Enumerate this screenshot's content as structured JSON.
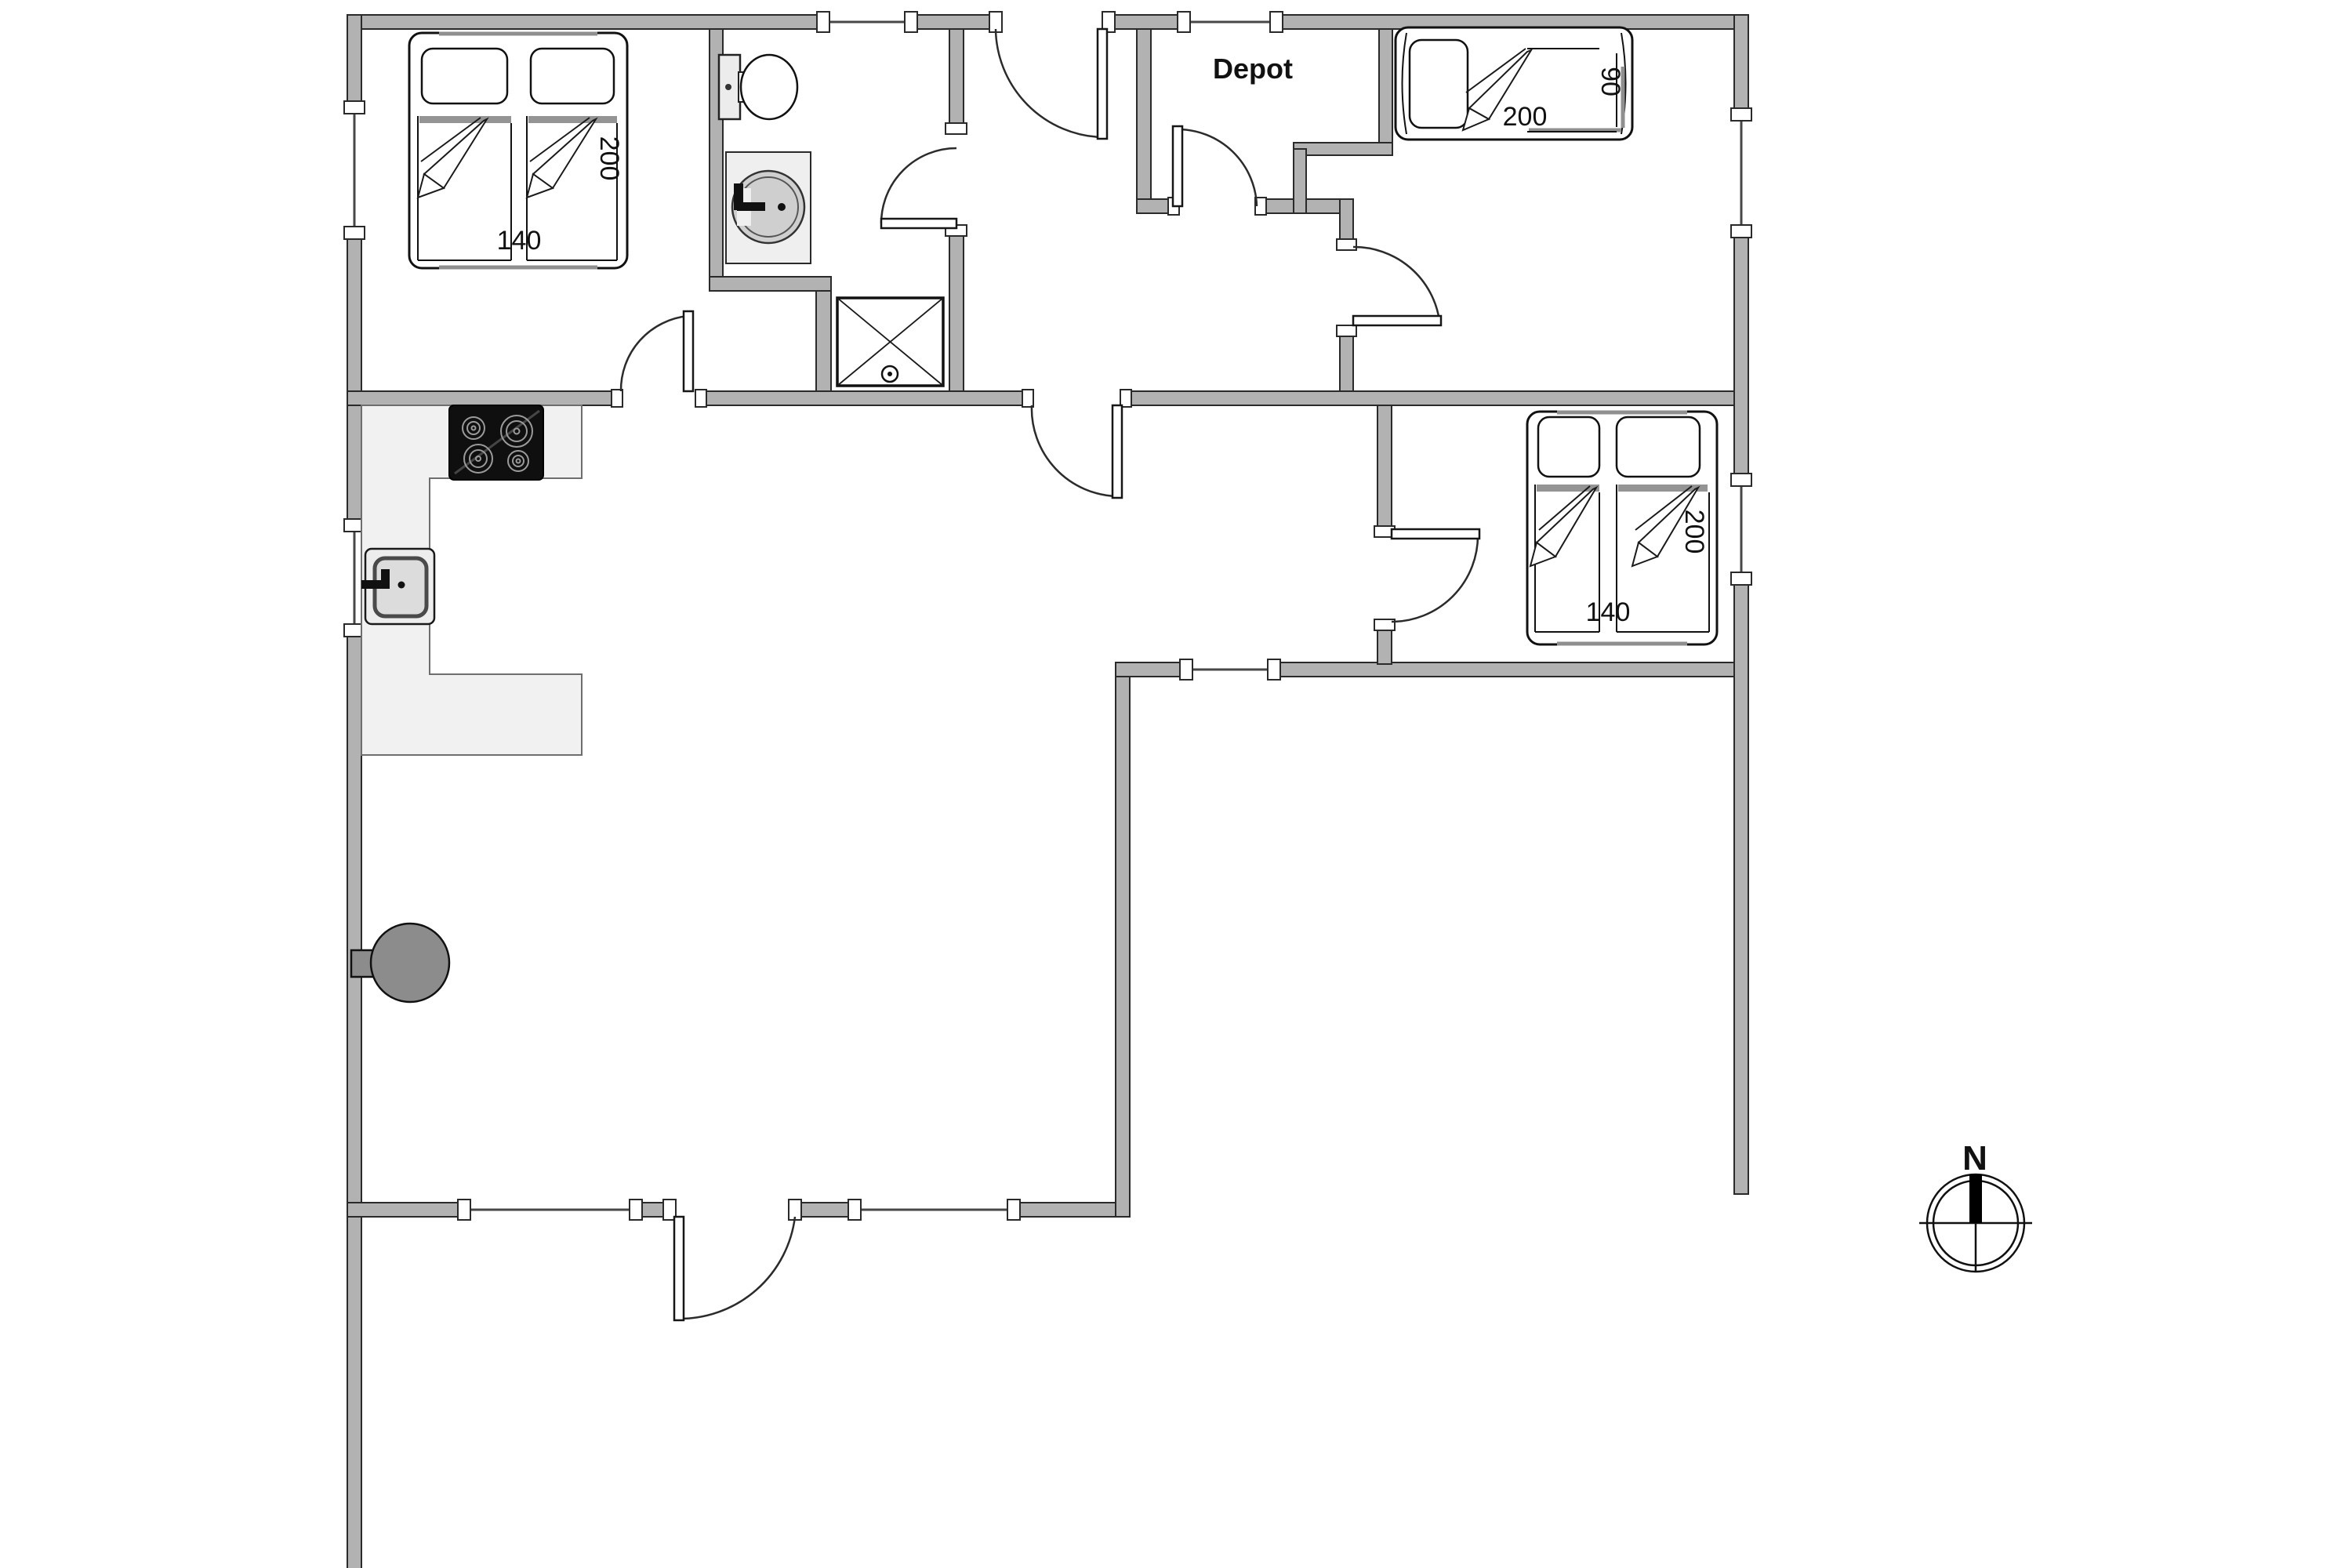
{
  "plan_title": "Holiday home floor plan",
  "rooms": {
    "depot_label": "Depot"
  },
  "beds": {
    "top_left": {
      "length": "200",
      "width": "140"
    },
    "top_right": {
      "length": "200",
      "width": "90"
    },
    "middle_right": {
      "length": "200",
      "width": "140"
    }
  },
  "compass": {
    "north_label": "N"
  },
  "fixtures": [
    "double-bed",
    "single-bed",
    "double-bed",
    "toilet",
    "wash-basin",
    "shower",
    "cooktop",
    "kitchen-sink",
    "wood-stove",
    "compass-rose"
  ],
  "colors": {
    "wall": "#b2b2b2",
    "wall-outline": "#2a2a2a",
    "counter": "#f1f1f1",
    "counter-outline": "#6e6e6e",
    "fixture-gray": "#8c8c8c",
    "basin-gray": "#cfcfcf",
    "cooktop": "#0f0f0f",
    "line": "#2b2b2b",
    "text": "#111111",
    "bg": "#ffffff"
  }
}
